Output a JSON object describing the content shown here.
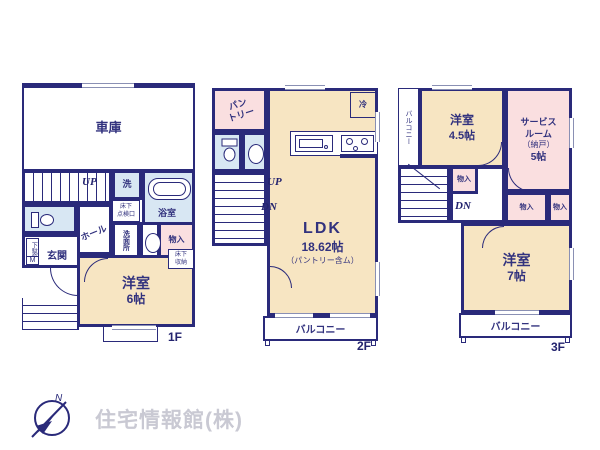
{
  "floor1": {
    "tag": "1F",
    "garage": "車庫",
    "up": "UP",
    "washer": "洗",
    "bath": "浴室",
    "inspection_line1": "床下",
    "inspection_line2": "点検口",
    "washroom": "洗面所",
    "closet": "物入",
    "shoe_cabinet": "下駄箱",
    "shoe_cabinet_m": "M",
    "entrance": "玄関",
    "hall": "ホール",
    "underfloor_line1": "床下",
    "underfloor_line2": "収納",
    "bedroom": "洋室",
    "bedroom_size": "6帖"
  },
  "floor2": {
    "tag": "2F",
    "pantry_line1": "パン",
    "pantry_line2": "トリー",
    "up": "UP",
    "dn": "DN",
    "fridge": "冷",
    "ldk": "LDK",
    "ldk_size": "18.62帖",
    "ldk_note": "（パントリー含ム）",
    "balcony": "バルコニー"
  },
  "floor3": {
    "tag": "3F",
    "balcony_side": "バルコニー",
    "bedroom1": "洋室",
    "bedroom1_size": "4.5帖",
    "service_line1": "サービス",
    "service_line2": "ルーム",
    "service_line3": "（納戸）",
    "service_line4": "5帖",
    "closet": "物入",
    "dn": "DN",
    "bedroom2": "洋室",
    "bedroom2_size": "7帖",
    "balcony": "バルコニー"
  },
  "logo": {
    "company": "住宅情報館(株)",
    "north_mark": "N"
  },
  "colors": {
    "wall": "#2a2a7a",
    "room_cream": "#f7e5c2",
    "room_pink": "#fadfe0",
    "room_blue": "#d8e7f3",
    "label_text": "#32327e",
    "logo_text": "#c9c9d3"
  }
}
